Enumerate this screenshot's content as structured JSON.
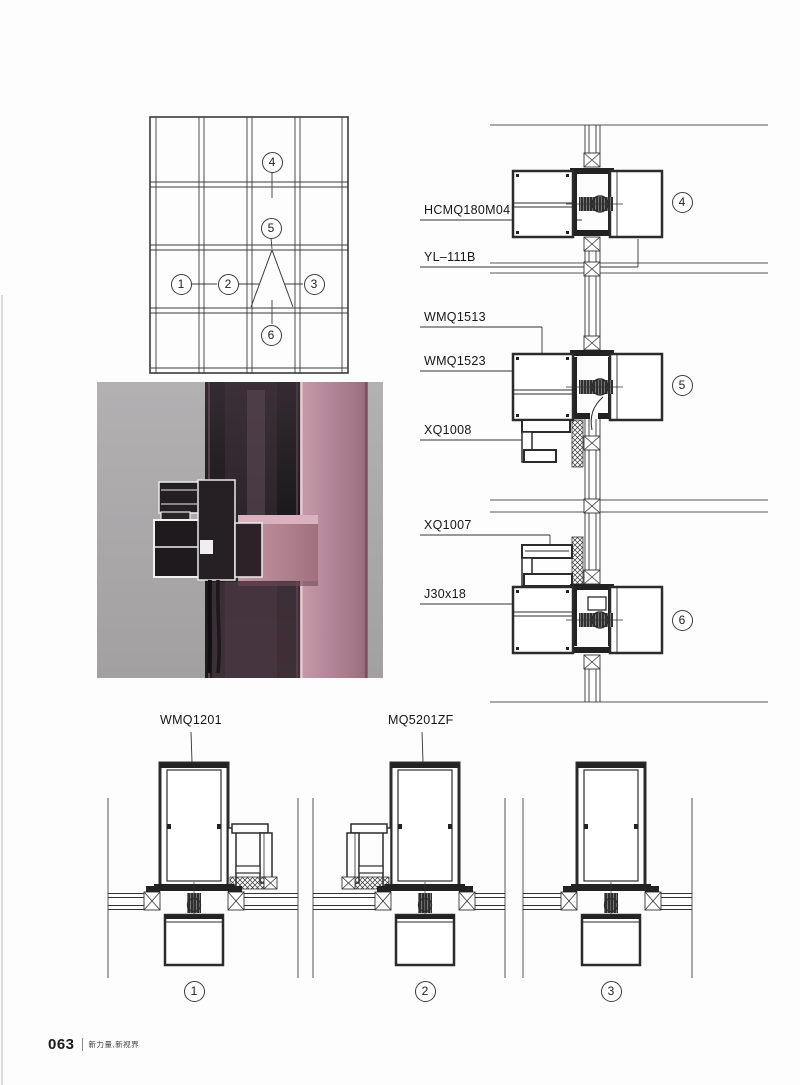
{
  "footer": {
    "page_number": "063",
    "tagline": "新力量,新视界"
  },
  "elevation_callouts": {
    "n1": "1",
    "n2": "2",
    "n3": "3",
    "n4": "4",
    "n5": "5",
    "n6": "6"
  },
  "vertical_section_labels": {
    "hcmq180m04": "HCMQ180M04",
    "yl111b": "YL–111B",
    "wmq1513": "WMQ1513",
    "wmq1523": "WMQ1523",
    "xq1008": "XQ1008",
    "xq1007": "XQ1007",
    "j30x18": "J30x18"
  },
  "vertical_section_callouts": {
    "n4": "4",
    "n5": "5",
    "n6": "6"
  },
  "horizontal_section_labels": {
    "wmq1201": "WMQ1201",
    "mq5201zf": "MQ5201ZF"
  },
  "horizontal_section_callouts": {
    "n1": "1",
    "n2": "2",
    "n3": "3"
  },
  "colors": {
    "paper": "#fdfdfd",
    "drawing_line": "#333333",
    "photo_background": "#a9a7a8",
    "profile_pink": "#b0808f",
    "profile_pink_dark": "#8d6070",
    "glass_dark": "#1e191d"
  }
}
